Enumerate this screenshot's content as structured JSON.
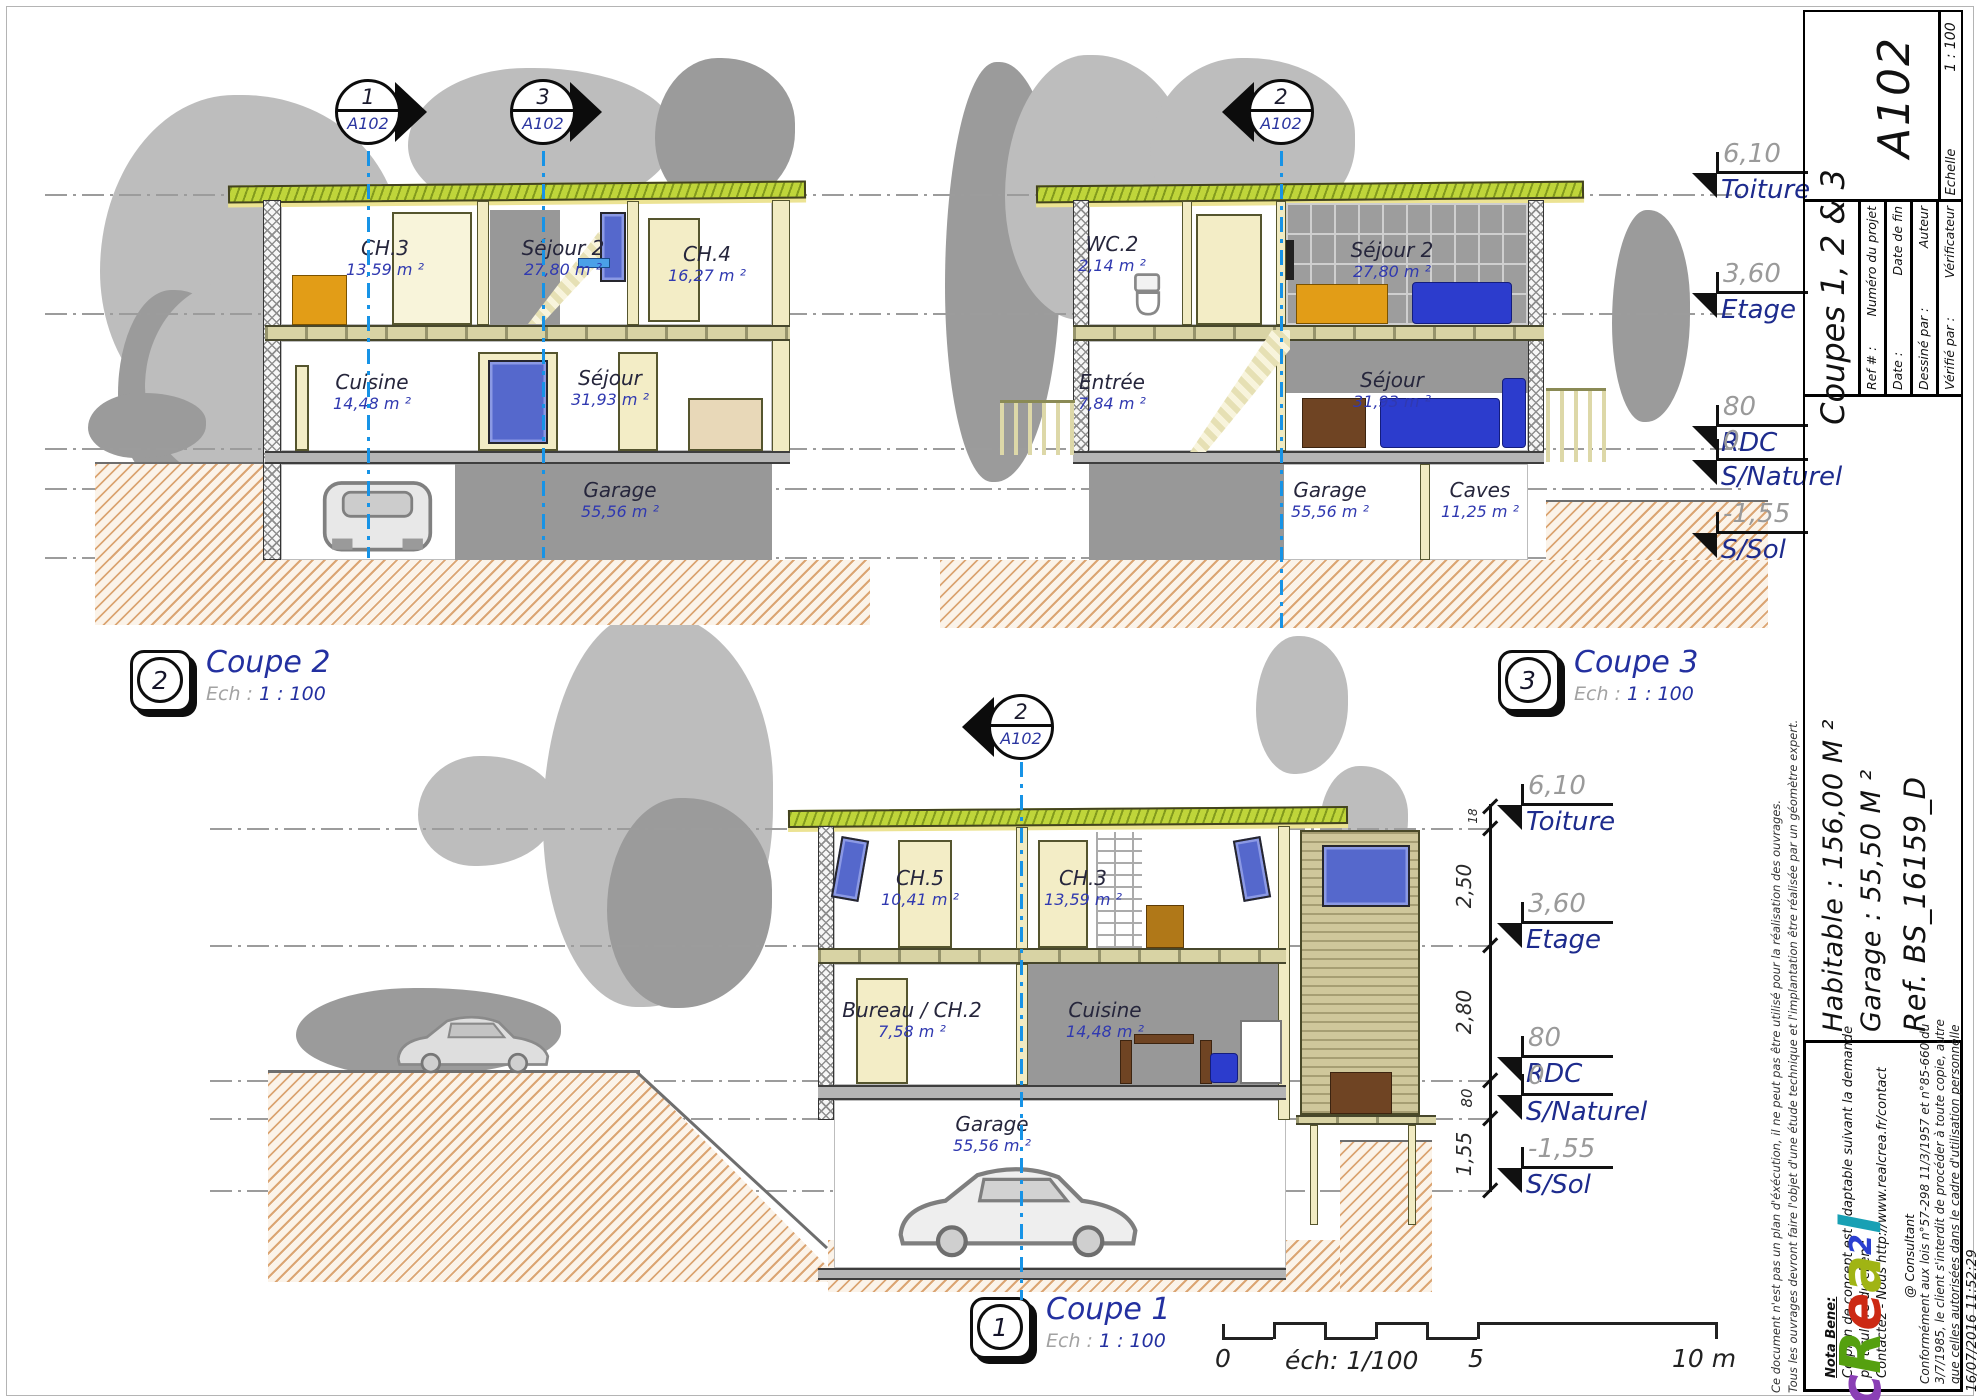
{
  "title_block": {
    "sheet_number": "A102",
    "sheet_title": "Coupes 1, 2 & 3",
    "scale_label": "Echelle",
    "scale_value": "1 : 100",
    "fields": [
      {
        "value": "Ref # :",
        "label": "Numéro du projet"
      },
      {
        "value": "Date :",
        "label": "Date de fin"
      },
      {
        "value": "Dessiné par :",
        "label": "Auteur"
      },
      {
        "value": "Vérifié par :",
        "label": "Vérificateur"
      }
    ],
    "summary": [
      "Habitable : 156,00 M ²",
      "Garage : 55,50 M ²",
      "Ref. BS_16159_D"
    ],
    "nota_heading": "Nota Bene:",
    "nota_lines": [
      "Ce plan de concept est adaptable suivant la demande",
      "particulière du clien :",
      "Contactez - Nous http://www.realcrea.fr/contact"
    ],
    "legal_lines": [
      "Conformément aux lois n°57-298 11/3/1957 et n°85-660 du",
      "3/7/1985, le client s'interdit de procéder à toute copie, autre",
      "que celles autorisées dans le cadre d'utilisation personnelle"
    ],
    "disclaimer_lines": [
      "Ce document n'est pas un plan d'éxécution, il ne peut pas être utilisé pour la réalisation des ouvrages.",
      "Tous les ouvrages devront faire l'objet d'une étude technique et l'implantation être réalisée par un géomètre expert."
    ],
    "logo": {
      "c": "c",
      "r": "R",
      "e": "e",
      "a": "a",
      "two": "2",
      "l": "l"
    },
    "logo_colors": [
      "#8a3fb5",
      "#55a00f",
      "#cc2a14",
      "#a0b414",
      "#2b3fd0",
      "#18a0b4"
    ],
    "logo_suffix": "@ Consultant",
    "timestamp": "16/07/2016 11:52:29"
  },
  "views": {
    "coupe2": {
      "icon_num": "2",
      "title": "Coupe 2",
      "ech_label": "Ech :",
      "ech_value": "1 : 100",
      "markers": [
        {
          "num": "1",
          "sheet": "A102"
        },
        {
          "num": "3",
          "sheet": "A102"
        }
      ],
      "rooms": [
        {
          "name": "CH.3",
          "area": "13,59 m ²"
        },
        {
          "name": "Séjour 2",
          "area": "27,80 m ²"
        },
        {
          "name": "CH.4",
          "area": "16,27 m ²"
        },
        {
          "name": "Cuisine",
          "area": "14,48 m ²"
        },
        {
          "name": "Séjour",
          "area": "31,93 m ²"
        },
        {
          "name": "Garage",
          "area": "55,56 m ²"
        }
      ]
    },
    "coupe3": {
      "icon_num": "3",
      "title": "Coupe 3",
      "ech_label": "Ech :",
      "ech_value": "1 : 100",
      "markers": [
        {
          "num": "2",
          "sheet": "A102"
        }
      ],
      "rooms": [
        {
          "name": "WC.2",
          "area": "2,14 m ²"
        },
        {
          "name": "Séjour 2",
          "area": "27,80 m ²"
        },
        {
          "name": "Entrée",
          "area": "7,84 m ²"
        },
        {
          "name": "Séjour",
          "area": "31,93 m ²"
        },
        {
          "name": "Garage",
          "area": "55,56 m ²"
        },
        {
          "name": "Caves",
          "area": "11,25 m ²"
        }
      ]
    },
    "coupe1": {
      "icon_num": "1",
      "title": "Coupe 1",
      "ech_label": "Ech :",
      "ech_value": "1 : 100",
      "markers": [
        {
          "num": "2",
          "sheet": "A102"
        }
      ],
      "rooms": [
        {
          "name": "CH.5",
          "area": "10,41 m ²"
        },
        {
          "name": "CH.3",
          "area": "13,59 m ²"
        },
        {
          "name": "Bureau / CH.2",
          "area": "7,58 m ²"
        },
        {
          "name": "Cuisine",
          "area": "14,48 m ²"
        },
        {
          "name": "Garage",
          "area": "55,56 m ²"
        }
      ]
    }
  },
  "levels": {
    "top": [
      {
        "value": "6,10",
        "name": "Toiture"
      },
      {
        "value": "3,60",
        "name": "Etage"
      },
      {
        "value": "80",
        "name": "RDC"
      },
      {
        "value": "0",
        "name": "S/Naturel"
      },
      {
        "value": "-1,55",
        "name": "S/Sol"
      }
    ],
    "bottom": [
      {
        "value": "6,10",
        "name": "Toiture"
      },
      {
        "value": "3,60",
        "name": "Etage"
      },
      {
        "value": "80",
        "name": "RDC"
      },
      {
        "value": "0",
        "name": "S/Naturel"
      },
      {
        "value": "-1,55",
        "name": "S/Sol"
      }
    ],
    "dims": [
      "18",
      "2,50",
      "2,80",
      "80",
      "1,55"
    ]
  },
  "scalebar": {
    "zero": "0",
    "ech": "éch: 1/100",
    "five": "5",
    "ten": "10 m"
  }
}
